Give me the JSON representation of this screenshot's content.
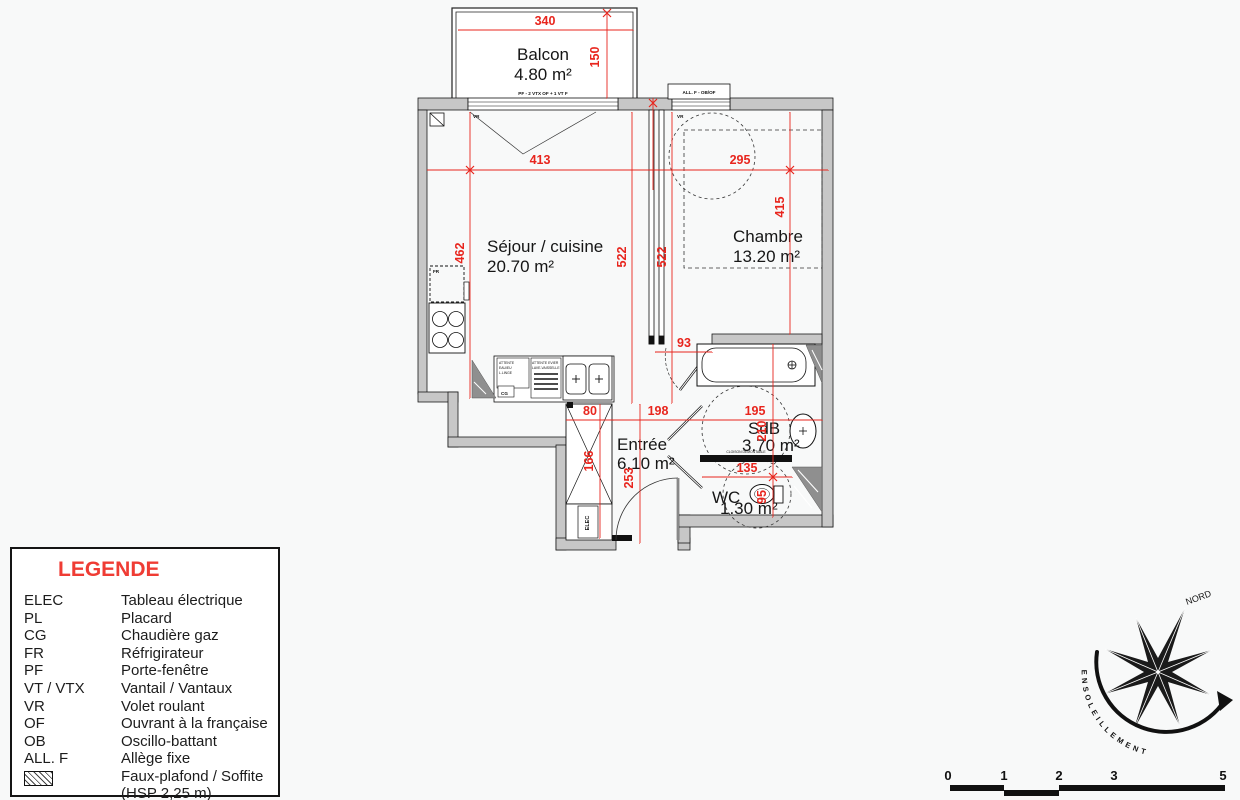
{
  "rooms": {
    "balcon": {
      "name": "Balcon",
      "area": "4.80 m²"
    },
    "sejour": {
      "name": "Séjour / cuisine",
      "area": "20.70 m²"
    },
    "chambre": {
      "name": "Chambre",
      "area": "13.20 m²"
    },
    "entree": {
      "name": "Entrée",
      "area": "6.10 m²"
    },
    "sdb": {
      "name": "SdB",
      "area": "3.70 m²"
    },
    "wc": {
      "name": "WC",
      "area": "1.30 m²"
    }
  },
  "dims": {
    "balcony_width": "340",
    "balcony_depth": "150",
    "sejour_width": "413",
    "chambre_width": "295",
    "sejour_depth": "462",
    "sejour_length": "522",
    "corridor_length": "522",
    "chambre_depth": "415",
    "door_width": "93",
    "sdb_depth": "210",
    "placard_width": "80",
    "entree_width": "198",
    "sdb_width": "195",
    "placard_depth": "166",
    "entree_depth": "253",
    "wc_width": "135",
    "wc_depth": "95"
  },
  "annotations": {
    "pf_window": "PF - 2 VTX OF + 1 VT F",
    "allf_window": "ALL. F - OB/OF",
    "vr_left": "VR",
    "vr_right": "VR",
    "fr": "FR",
    "cg": "CG",
    "elec": "ELEC",
    "cloison": "CLOISON DEMONTABLE",
    "attente1_l1": "ATTENTE",
    "attente1_l2": "EAU/EU",
    "attente1_l3": "L.LINGE",
    "attente2_l1": "ATTENTE EVIER",
    "attente2_l2": "LAVE-VAISSELLE"
  },
  "legend": {
    "title": "LEGENDE",
    "rows": [
      {
        "abbr": "ELEC",
        "label": "Tableau électrique"
      },
      {
        "abbr": "PL",
        "label": "Placard"
      },
      {
        "abbr": "CG",
        "label": "Chaudière gaz"
      },
      {
        "abbr": "FR",
        "label": "Réfrigirateur"
      },
      {
        "abbr": "PF",
        "label": "Porte-fenêtre"
      },
      {
        "abbr": "VT / VTX",
        "label": "Vantail / Vantaux"
      },
      {
        "abbr": "VR",
        "label": "Volet roulant"
      },
      {
        "abbr": "OF",
        "label": "Ouvrant à la française"
      },
      {
        "abbr": "OB",
        "label": "Oscillo-battant"
      },
      {
        "abbr": "ALL. F",
        "label": "Allège fixe"
      },
      {
        "abbr": "",
        "label": "Faux-plafond / Soffite",
        "label2": "(HSP 2,25 m)"
      }
    ]
  },
  "compass": {
    "north_label": "NORD",
    "arc_label": "ENSOLEILLEMENT"
  },
  "scalebar": {
    "ticks": [
      "0",
      "1",
      "2",
      "3",
      "5"
    ]
  },
  "colors": {
    "dimension_red": "#e8251d",
    "wall_gray": "#c7c7c7",
    "legend_title_red": "#ef3c34"
  }
}
